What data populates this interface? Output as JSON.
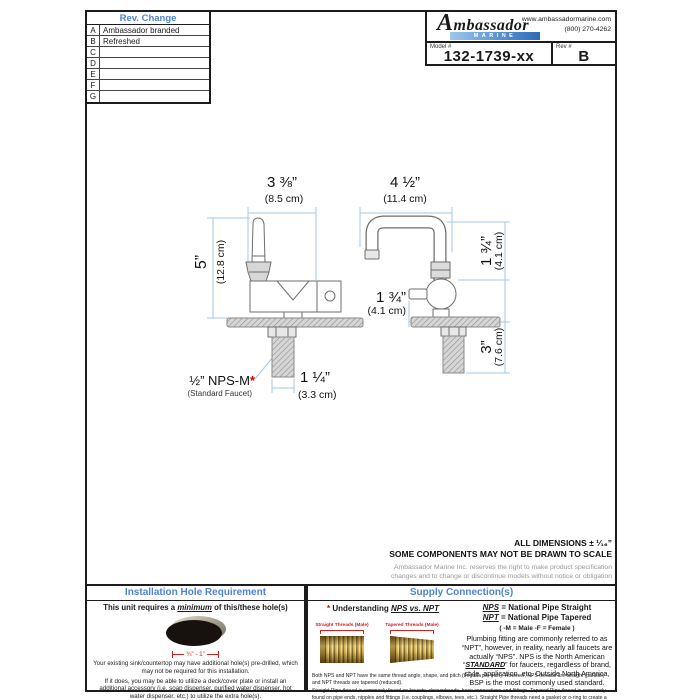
{
  "sheet": {
    "rev_table": {
      "title": "Rev. Change",
      "rows": [
        {
          "letter": "A",
          "change": "Ambassador branded"
        },
        {
          "letter": "B",
          "change": "Refreshed"
        },
        {
          "letter": "C",
          "change": ""
        },
        {
          "letter": "D",
          "change": ""
        },
        {
          "letter": "E",
          "change": ""
        },
        {
          "letter": "F",
          "change": ""
        },
        {
          "letter": "G",
          "change": ""
        }
      ]
    },
    "title_block": {
      "brand_name": "Ambassador",
      "brand_sub": "MARINE",
      "website": "www.ambassadormarine.com",
      "phone": "(800) 270-4262",
      "model_label": "Model #",
      "model_value": "132-1739-xx",
      "rev_label": "Rev #",
      "rev_value": "B"
    }
  },
  "drawing": {
    "front": {
      "width_in": "3 ⅜”",
      "width_cm": "(8.5 cm)",
      "height_in": "5”",
      "height_cm": "(12.8 cm)"
    },
    "side": {
      "reach_in": "4 ½”",
      "reach_cm": "(11.4 cm)",
      "spout_height_in": "1 ¾”",
      "spout_height_cm": "(4.1 cm)",
      "handle_in": "1 ¾”",
      "handle_cm": "(4.1 cm)",
      "below_deck_in": "3”",
      "below_deck_cm": "(7.6 cm)",
      "shank_width_in": "1 ¼”",
      "shank_width_cm": "(3.3 cm)"
    },
    "thread_label": "½” NPS-M",
    "thread_star": "*",
    "thread_sublabel": "(Standard Faucet)"
  },
  "notes": {
    "dims_tolerance": "ALL DIMENSIONS ± ¹⁄₁₆”",
    "scale_note": "SOME COMPONENTS MAY NOT BE DRAWN TO SCALE",
    "disclaimer_line1": "Ambassador Marine Inc. reserves the right to make product specification",
    "disclaimer_line2": "changes and to change or discontinue models without notice or obligation"
  },
  "installation_panel": {
    "title": "Installation Hole Requirement",
    "subtitle_pre": "This unit requires a ",
    "subtitle_em": "minimum",
    "subtitle_post": " of this/these hole(s)",
    "hole_dim": "¾” - 1”",
    "fine_print": [
      "Your existing sink/countertop may have additional hole(s) pre-drilled, which may not be required for this installation.",
      "If it does, you may be able to utilize a deck/cover plate or install an additional accessory (i.e. soap dispenser, purified water dispenser, hot water dispenser, etc.) to utilize the extra hole(s).",
      "We offer a variety of deck/cover plates and soap dispensers to coordinate with your faucet and decor."
    ]
  },
  "supply_panel": {
    "title": "Supply Connection(s)",
    "understanding_star": "*",
    "understanding_pre": " Understanding ",
    "understanding_em": "NPS vs. NPT",
    "straight_label": "Straight Threads (Male)",
    "tapered_label": "Tapered Threads (Male)",
    "nps_abbr": "NPS",
    "nps_def": " = National Pipe Straight",
    "npt_abbr": "NPT",
    "npt_def": " = National Pipe Tapered",
    "gender_note": "( -M = Male      -F = Female )",
    "para_pre": "Plumbing fitting are commonly referred to as “NPT”, however, in reality, nearly all faucets are actually “NPS”. NPS is the North American “",
    "para_em": "STANDARD",
    "para_post": "” for faucets, regardless of brand, style, application, etc.  Outside North America, BSP is the most commonly used standard.",
    "fine_print": [
      "Both NPS and NPT have the same thread angle, shape, and pitch (threads per inch).  However, NPS threads are straight (parallel) and NPT threads are tapered (reduced).",
      "Straight Pipe thread is commonly found on faucets, showerheads, hose connections and fittings.  Tapered Pipe thread is commonly found on pipe ends, nipples and fittings (i.e. couplings, elbows, tees, etc.).  Straight Pipe threads need a gasket or o-ring to create a seal.  Both styles require sealant or plumber’s tape for optimal seal.  While NPS and NPT threads will engage, they do not seal properly with each other."
    ]
  }
}
